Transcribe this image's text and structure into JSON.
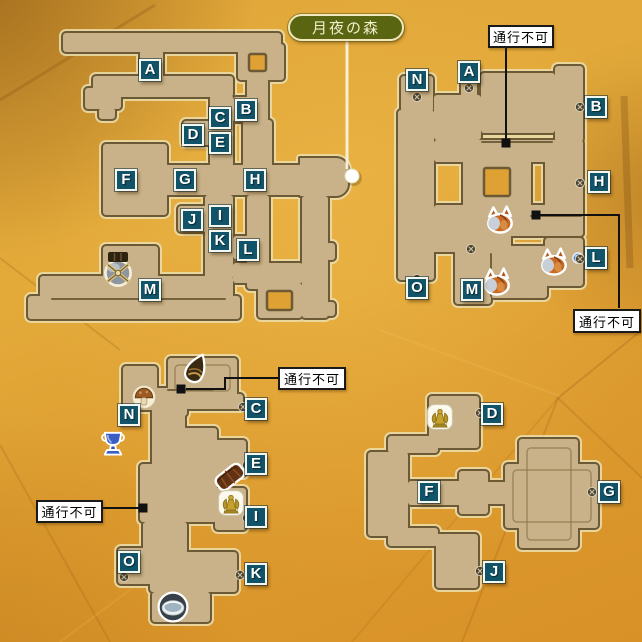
{
  "area_link": {
    "text": "月夜の森",
    "x": 288,
    "y": 14,
    "w": 116,
    "h": 27,
    "dot_x": 352,
    "dot_y": 176
  },
  "impassable_text": "通行不可",
  "blocked_labels": [
    {
      "text": "通行不可",
      "x": 488,
      "y": 25,
      "w": 66,
      "h": 23
    },
    {
      "text": "通行不可",
      "x": 573,
      "y": 309,
      "w": 68,
      "h": 24
    },
    {
      "text": "通行不可",
      "x": 278,
      "y": 367,
      "w": 68,
      "h": 23
    },
    {
      "text": "通行不可",
      "x": 36,
      "y": 500,
      "w": 67,
      "h": 23
    }
  ],
  "sections": {
    "upper_west": {
      "markers": [
        {
          "label": "A",
          "x": 150,
          "y": 70
        },
        {
          "label": "B",
          "x": 246,
          "y": 110
        },
        {
          "label": "C",
          "x": 220,
          "y": 118
        },
        {
          "label": "D",
          "x": 193,
          "y": 135
        },
        {
          "label": "E",
          "x": 220,
          "y": 143
        },
        {
          "label": "F",
          "x": 126,
          "y": 180
        },
        {
          "label": "G",
          "x": 185,
          "y": 180
        },
        {
          "label": "H",
          "x": 255,
          "y": 180
        },
        {
          "label": "J",
          "x": 192,
          "y": 220
        },
        {
          "label": "I",
          "x": 220,
          "y": 216
        },
        {
          "label": "K",
          "x": 220,
          "y": 241
        },
        {
          "label": "L",
          "x": 248,
          "y": 250
        },
        {
          "label": "M",
          "x": 150,
          "y": 290
        }
      ]
    },
    "upper_east": {
      "markers": [
        {
          "label": "N",
          "x": 417,
          "y": 80
        },
        {
          "label": "A",
          "x": 469,
          "y": 72
        },
        {
          "label": "B",
          "x": 596,
          "y": 107
        },
        {
          "label": "H",
          "x": 599,
          "y": 182
        },
        {
          "label": "L",
          "x": 596,
          "y": 258
        },
        {
          "label": "M",
          "x": 472,
          "y": 290
        },
        {
          "label": "O",
          "x": 417,
          "y": 288
        }
      ]
    },
    "lower_west": {
      "markers": [
        {
          "label": "N",
          "x": 129,
          "y": 415
        },
        {
          "label": "C",
          "x": 256,
          "y": 409
        },
        {
          "label": "E",
          "x": 256,
          "y": 464
        },
        {
          "label": "I",
          "x": 256,
          "y": 517
        },
        {
          "label": "O",
          "x": 129,
          "y": 562
        },
        {
          "label": "K",
          "x": 256,
          "y": 574
        }
      ]
    },
    "lower_east": {
      "markers": [
        {
          "label": "D",
          "x": 492,
          "y": 414
        },
        {
          "label": "F",
          "x": 429,
          "y": 492
        },
        {
          "label": "G",
          "x": 609,
          "y": 492
        },
        {
          "label": "J",
          "x": 494,
          "y": 572
        }
      ]
    }
  },
  "icons": [
    {
      "type": "boss-orb",
      "x": 118,
      "y": 273
    },
    {
      "type": "stairs",
      "x": 118,
      "y": 257
    },
    {
      "type": "monster",
      "x": 500,
      "y": 220
    },
    {
      "type": "monster",
      "x": 554,
      "y": 262
    },
    {
      "type": "monster",
      "x": 497,
      "y": 282
    },
    {
      "type": "slime",
      "x": 578,
      "y": 258
    },
    {
      "type": "seed",
      "x": 196,
      "y": 369
    },
    {
      "type": "mushroom",
      "x": 144,
      "y": 397
    },
    {
      "type": "trophy",
      "x": 113,
      "y": 444
    },
    {
      "type": "plank",
      "x": 230,
      "y": 477
    },
    {
      "type": "statue",
      "x": 231,
      "y": 503
    },
    {
      "type": "statue",
      "x": 440,
      "y": 417
    },
    {
      "type": "basin",
      "x": 173,
      "y": 607
    },
    {
      "type": "door",
      "x": 417,
      "y": 97
    },
    {
      "type": "door",
      "x": 469,
      "y": 88
    },
    {
      "type": "door",
      "x": 580,
      "y": 107
    },
    {
      "type": "door",
      "x": 580,
      "y": 183
    },
    {
      "type": "door",
      "x": 580,
      "y": 259
    },
    {
      "type": "door",
      "x": 417,
      "y": 279
    },
    {
      "type": "door",
      "x": 471,
      "y": 249
    },
    {
      "type": "door",
      "x": 243,
      "y": 407
    },
    {
      "type": "door",
      "x": 247,
      "y": 465
    },
    {
      "type": "door",
      "x": 247,
      "y": 518
    },
    {
      "type": "door",
      "x": 240,
      "y": 575
    },
    {
      "type": "door",
      "x": 124,
      "y": 577
    },
    {
      "type": "door",
      "x": 480,
      "y": 413
    },
    {
      "type": "door",
      "x": 592,
      "y": 492
    },
    {
      "type": "door",
      "x": 480,
      "y": 571
    }
  ],
  "colors": {
    "background_gold": "#e0a536",
    "map_fill": "#c9b289",
    "map_outline": "#6b5a35",
    "map_halo": "#ecdfae",
    "marker_bg": "#115368",
    "marker_border": "#f4f7ee",
    "area_pill_bg": "#5a6512",
    "area_pill_text": "#f3efcd",
    "impassable_bg": "#ffffff",
    "impassable_border": "#1a1a1a",
    "connector_line": "#111111",
    "leader_line": "#f7f3dd"
  }
}
